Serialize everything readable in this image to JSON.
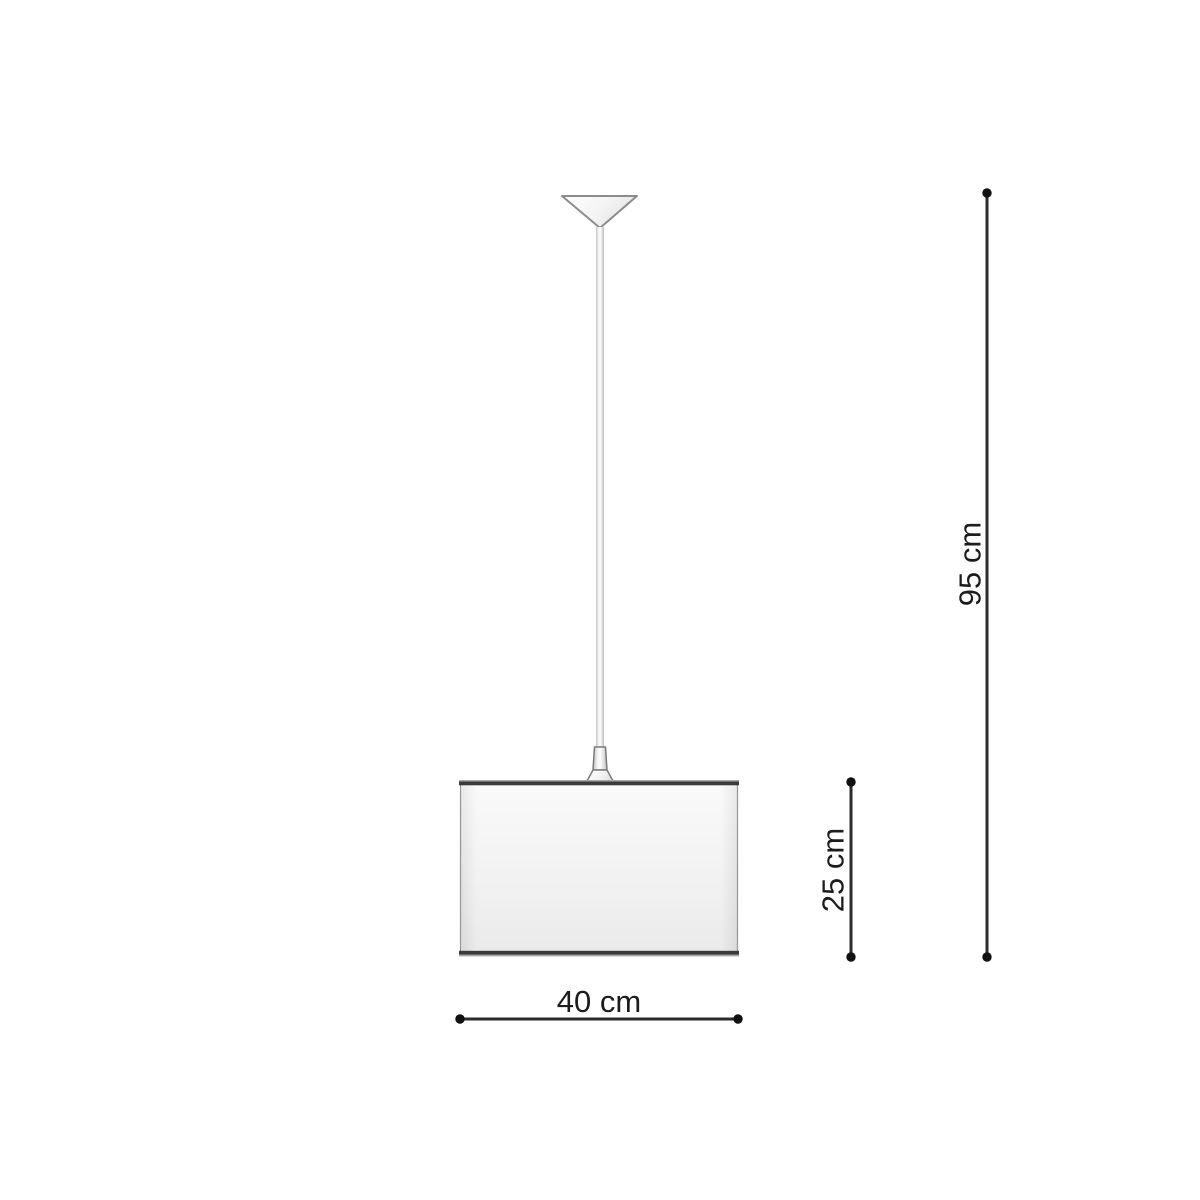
{
  "page": {
    "background": "#ffffff"
  },
  "diagram": {
    "dimensions": {
      "overall_height": {
        "label": "95 cm",
        "orientation": "vertical"
      },
      "shade_height": {
        "label": "25 cm",
        "orientation": "vertical"
      },
      "shade_width": {
        "label": "40 cm",
        "orientation": "horizontal"
      }
    },
    "colors": {
      "dimension_line": "#2b2b2b",
      "dimension_dot": "#111111",
      "label_text": "#1c1c1c",
      "shade_trim": "#3a3a3a",
      "outline_gray": "#8c8c8c"
    }
  }
}
